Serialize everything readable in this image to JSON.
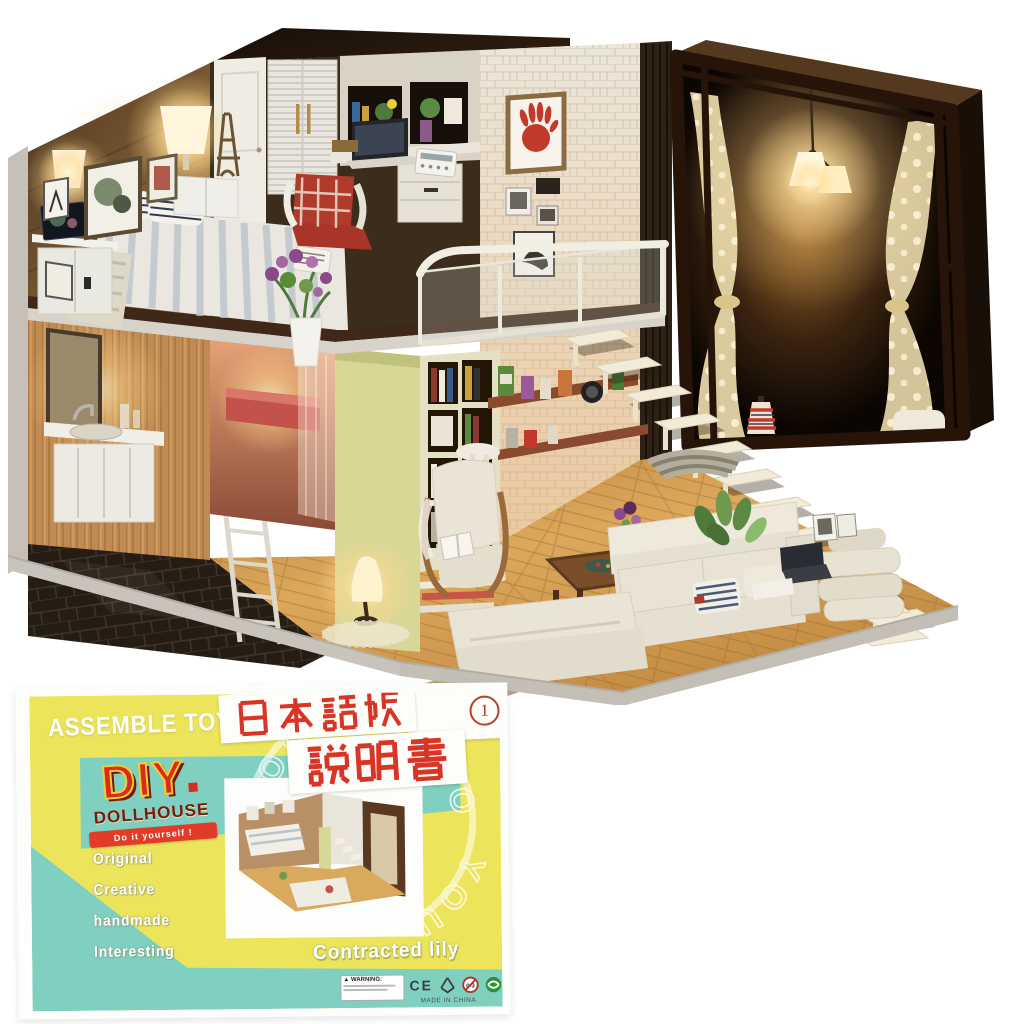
{
  "photo_colors": {
    "warm_glow": "#ffdf9e",
    "wood_floor": "#cf9a4e",
    "white_brick": "#ece6da",
    "dark_frame": "#2a1810",
    "base_gray": "#c9c4bb"
  },
  "box": {
    "assemble_toys": "ASSEMBLE TOYS",
    "jp_line1": "日本語版",
    "jp_line2": "説明書",
    "circled_number": "1",
    "diy": "DIY",
    "dollhouse": "DOLLHOUSE",
    "banner": "Do it yourself !",
    "features": [
      "Original",
      "Creative",
      "handmade",
      "Interesting"
    ],
    "stamp_text_top": "HOUSE ★ DO IT",
    "stamp_text_side": "YOU",
    "stamp_star": "★",
    "product_name": "Contracted lily",
    "warning_label": "WARNING:",
    "ce_mark": "CE",
    "made_in": "MADE IN CHINA",
    "colors": {
      "teal": "#7fd0c0",
      "yellow": "#ece45a",
      "red": "#d93425",
      "maroon": "#7c190d"
    }
  }
}
